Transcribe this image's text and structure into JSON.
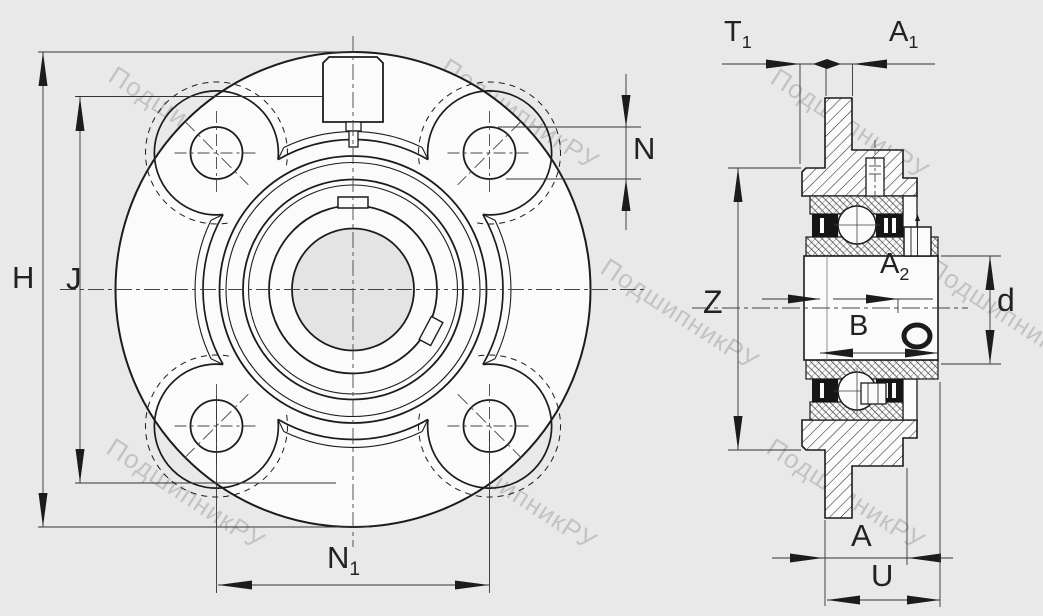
{
  "title": "",
  "watermark": {
    "text": "ПодшипникРУ"
  },
  "colors": {
    "background": "#e9e9e9",
    "paper": "#fbfbfb",
    "line": "#1c1c1c",
    "dim_line": "#333333",
    "bore_fill": "#e4e4e4",
    "watermark": "rgba(110,110,110,0.30)"
  },
  "views": {
    "front": {
      "name": "front-view-flanged-cartridge-unit"
    },
    "side": {
      "name": "side-section-view"
    }
  },
  "dimensions": {
    "H": {
      "base": "H",
      "sub": ""
    },
    "J": {
      "base": "J",
      "sub": ""
    },
    "N": {
      "base": "N",
      "sub": ""
    },
    "N1": {
      "base": "N",
      "sub": "1"
    },
    "T1": {
      "base": "T",
      "sub": "1"
    },
    "A1": {
      "base": "A",
      "sub": "1"
    },
    "Z": {
      "base": "Z",
      "sub": ""
    },
    "A2": {
      "base": "A",
      "sub": "2"
    },
    "B": {
      "base": "B",
      "sub": ""
    },
    "d": {
      "base": "d",
      "sub": ""
    },
    "A": {
      "base": "A",
      "sub": ""
    },
    "U": {
      "base": "U",
      "sub": ""
    }
  }
}
